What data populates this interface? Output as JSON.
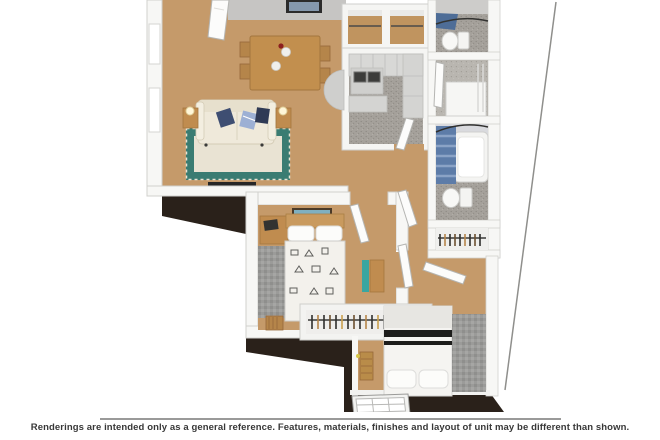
{
  "disclaimer": {
    "text": "Renderings are intended only as a general reference. Features, materials, finishes and layout of unit may be different than shown."
  },
  "palette": {
    "floor_tan": "#c59a6a",
    "wall_white": "#f7f7f5",
    "wall_outline": "#cfcfcc",
    "far_wall_gray": "#c6c5c3",
    "exterior_dark": "#2a211a",
    "kitchen_bath_floor": "#a5a19b",
    "cabinet_gray": "#d8d8d6",
    "rug_teal": "#3a7c72",
    "rug_cream": "#e9e3d3",
    "sofa_cream": "#efe9da",
    "pillow_navy": "#3e4e72",
    "shower_curtain_blue": "#5d7ca8",
    "wood": "#c08c4f",
    "bed_stripe_black": "#1d1d1b",
    "bedroom_rug_gray": "#9b9b99",
    "divider_gray": "#9a9a99",
    "caption_text": "#383838"
  }
}
